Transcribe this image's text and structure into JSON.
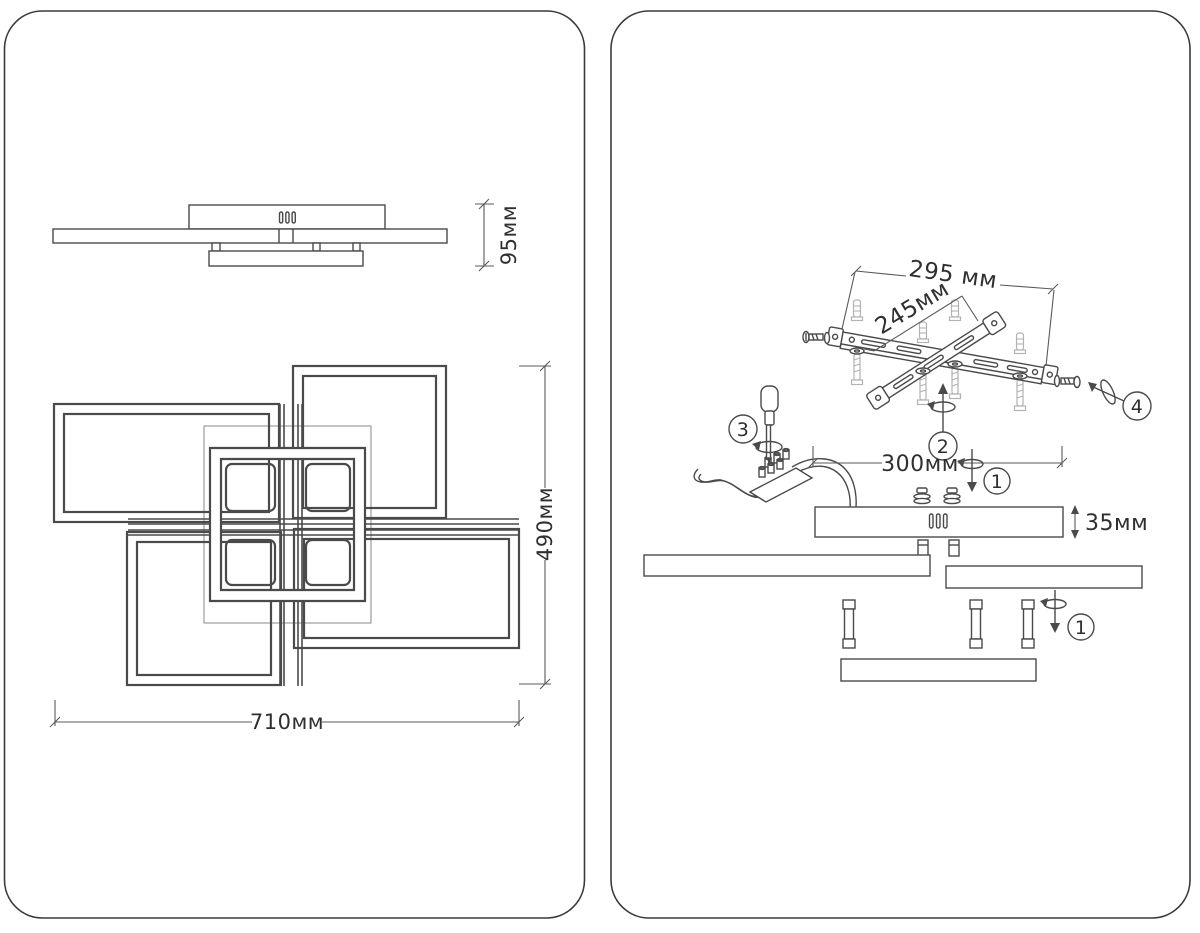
{
  "colors": {
    "line": "#4a4a4a",
    "light_gray": "#b2b2b2",
    "text": "#2f2f2f",
    "panel_border": "#3a3a3a",
    "background": "#ffffff"
  },
  "left_panel": {
    "side_view": {
      "height_dim": "95мм"
    },
    "top_view": {
      "width_dim": "710мм",
      "height_dim": "490мм"
    }
  },
  "right_panel": {
    "bracket": {
      "outer_dim": "295 мм",
      "holes_dim": "245мм"
    },
    "canopy": {
      "width_dim": "300мм",
      "height_dim": "35мм"
    },
    "steps": {
      "one": "1",
      "two": "2",
      "three": "3",
      "four": "4"
    }
  }
}
